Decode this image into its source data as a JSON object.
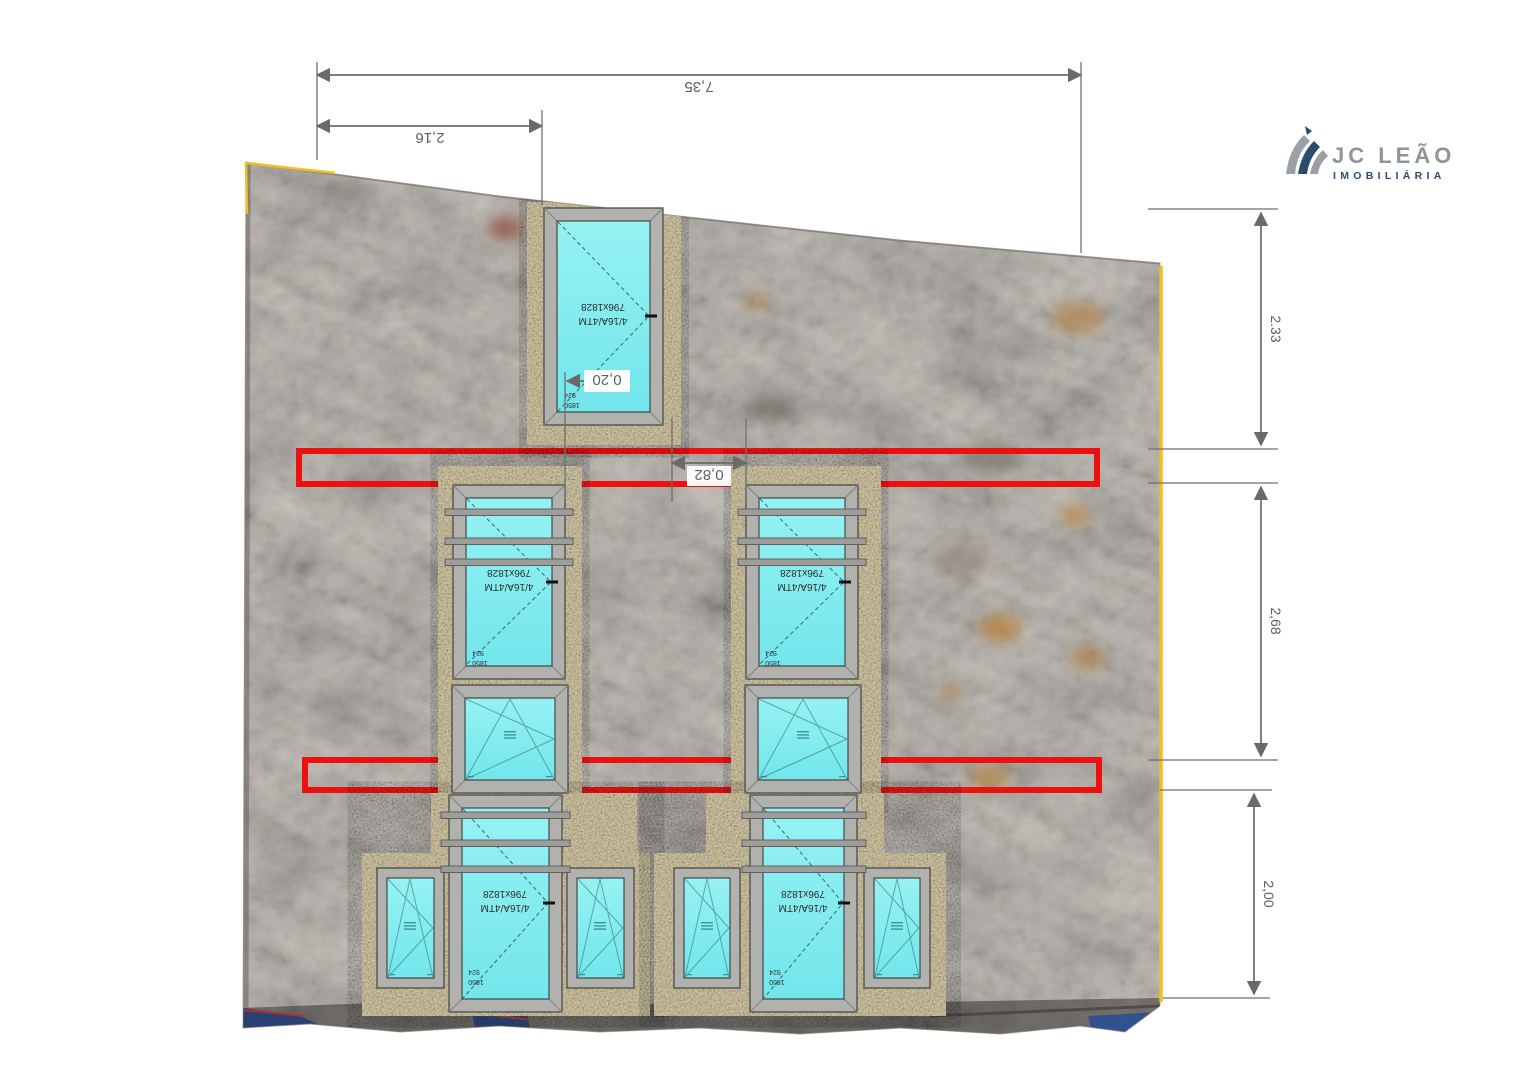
{
  "logo": {
    "brand": "JC LEÃO",
    "tagline": "IMOBILIÁRIA"
  },
  "dimensions": {
    "overall_width": "7,35",
    "left_segment_width": "2,16",
    "upper_height": "2.33",
    "middle_height": "2,68",
    "lower_height": "2,00",
    "window_gap": "0,82",
    "jamb_offset": "0,20"
  },
  "window_spec": {
    "glazing": "4/16A/4TM",
    "size": "796x1828",
    "frame_width": "924",
    "frame_height": "1850"
  },
  "colors": {
    "glass_cyan": "#7fe9ee",
    "frame_gray": "#b1b1ae",
    "marking_red": "#ec1111",
    "survey_yellow": "#f0c020",
    "logo_navy": "#2c4b6e",
    "logo_gray": "#8e959b",
    "dimension_gray": "#6a6a6a"
  }
}
